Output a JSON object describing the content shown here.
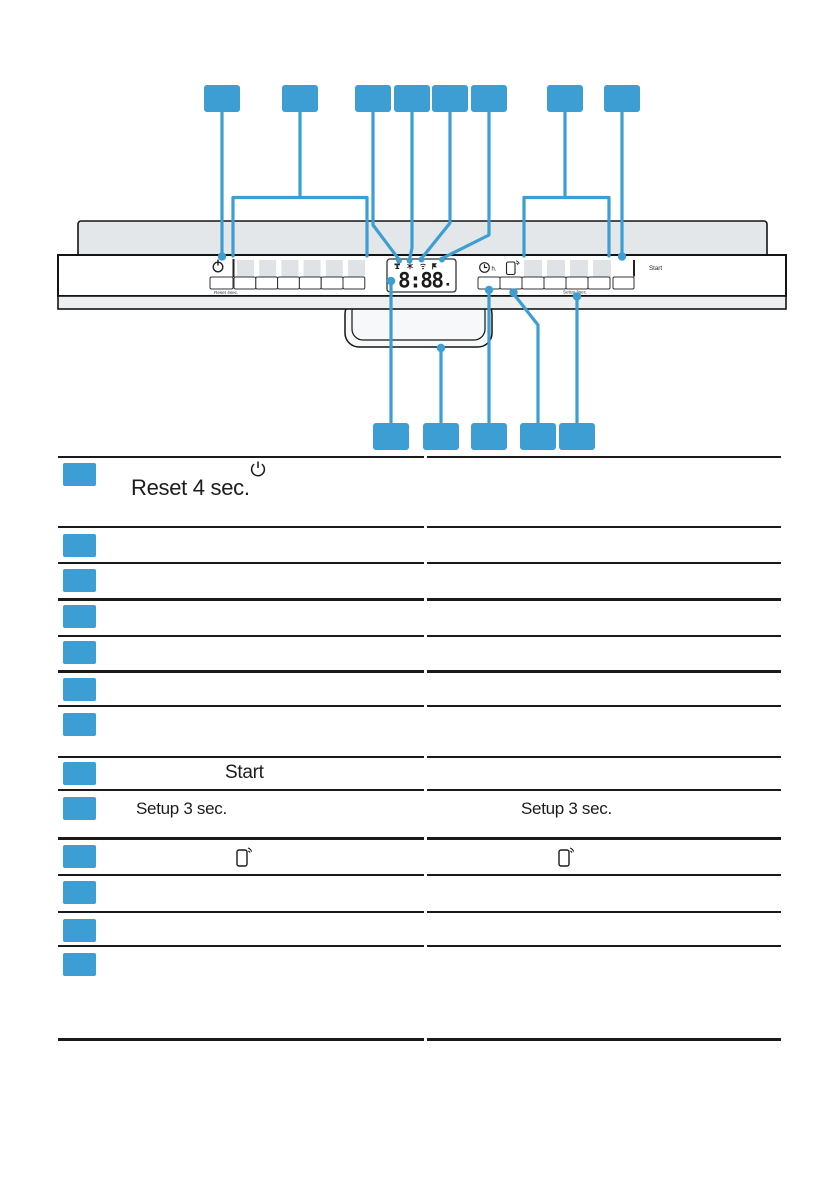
{
  "colors": {
    "accent_blue": "#3c9ed2",
    "panel_gray": "#e4e7e9",
    "button_gray": "#e0e3e5",
    "rule_black": "#1a1a1a"
  },
  "panel": {
    "power_icon": "power-icon",
    "reset_label": "Reset 4sec.",
    "display_digits": "8:88",
    "display_icons": [
      "tap-icon",
      "salt-icon",
      "wifi-icon",
      "rinse-aid-icon"
    ],
    "clock_icon": "time-icon",
    "clock_unit": "h.",
    "phone_icon": "remote-start-icon",
    "start_label": "Start",
    "setup_label": "Setup 3sec."
  },
  "callouts": {
    "top_count": 8,
    "bottom_count": 5
  },
  "table": {
    "rows": [
      {
        "left_icon": "power-icon",
        "left_text": "Reset 4 sec.",
        "right_text": ""
      },
      {
        "left_text": "",
        "right_text": ""
      },
      {
        "left_text": "",
        "right_text": ""
      },
      {
        "left_text": "",
        "right_text": ""
      },
      {
        "left_text": "",
        "right_text": ""
      },
      {
        "left_text": "",
        "right_text": ""
      },
      {
        "left_text": "",
        "right_text": ""
      },
      {
        "left_text": "Start",
        "right_text": ""
      },
      {
        "left_text": "Setup 3 sec.",
        "right_text": "Setup 3 sec."
      },
      {
        "left_icon": "phone-icon",
        "right_icon": "phone-icon"
      },
      {
        "left_text": "",
        "right_text": ""
      },
      {
        "left_text": "",
        "right_text": ""
      },
      {
        "left_text": "",
        "right_text": ""
      }
    ]
  }
}
